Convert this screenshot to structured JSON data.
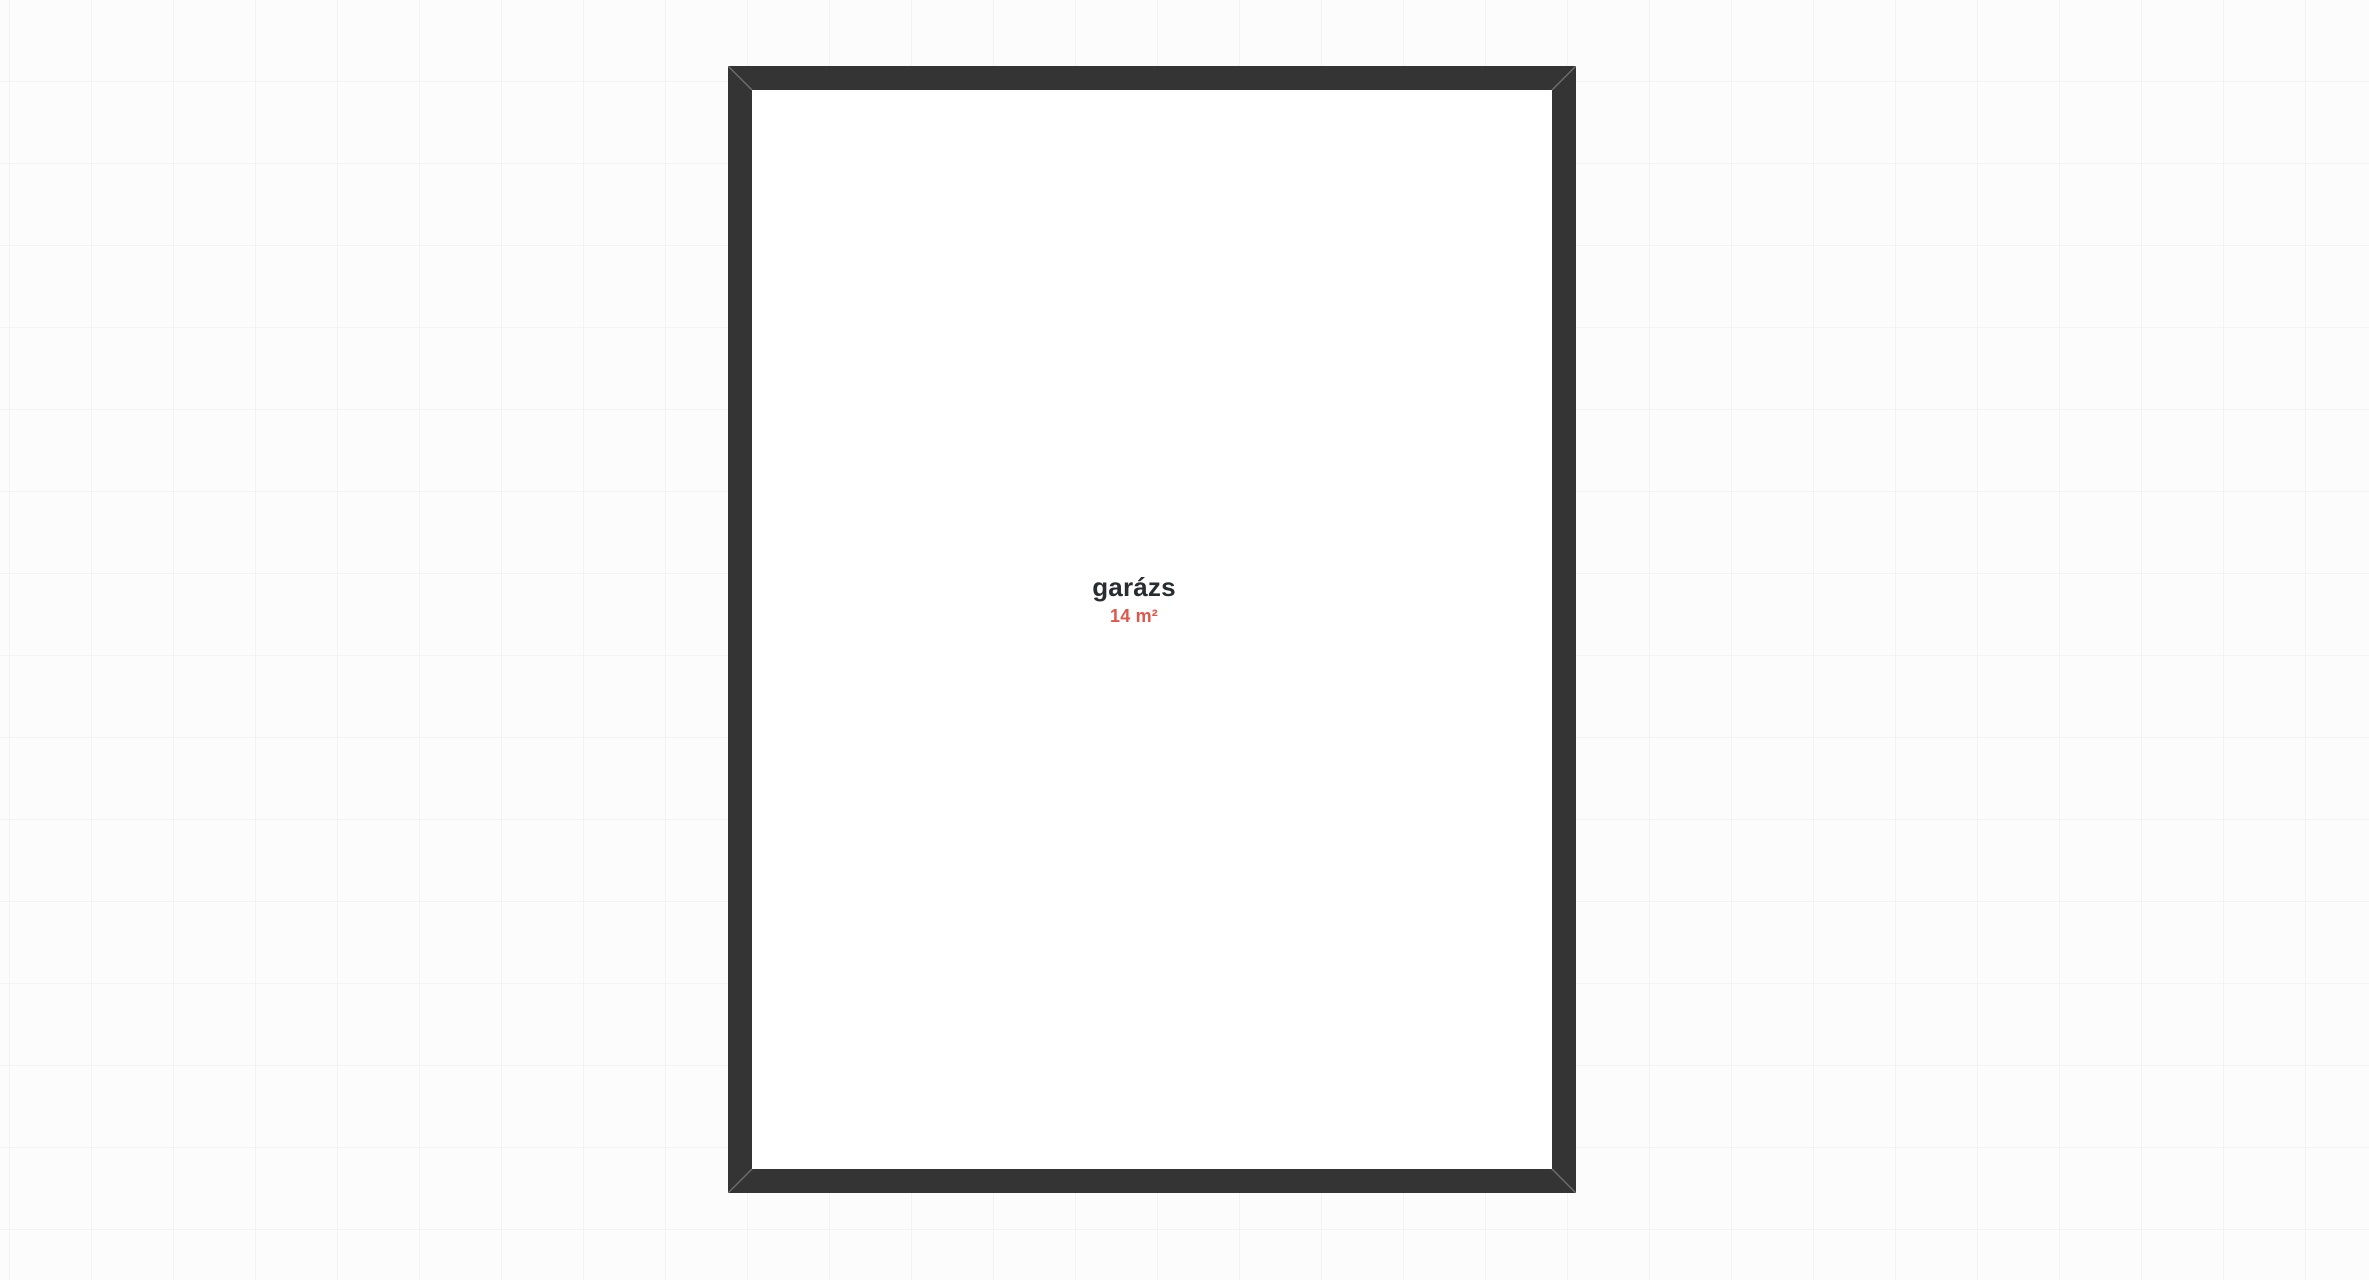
{
  "colors": {
    "canvas_bg": "#fcfcfc",
    "grid_line": "#f3f3f3",
    "wall": "#343434",
    "room_fill": "#ffffff",
    "room_name_text": "#2b2c31",
    "room_area_text": "#e0564a"
  },
  "canvas": {
    "grid_size_px": 82
  },
  "floorplan": {
    "room": {
      "name": "garázs",
      "area": "14 m²"
    }
  }
}
